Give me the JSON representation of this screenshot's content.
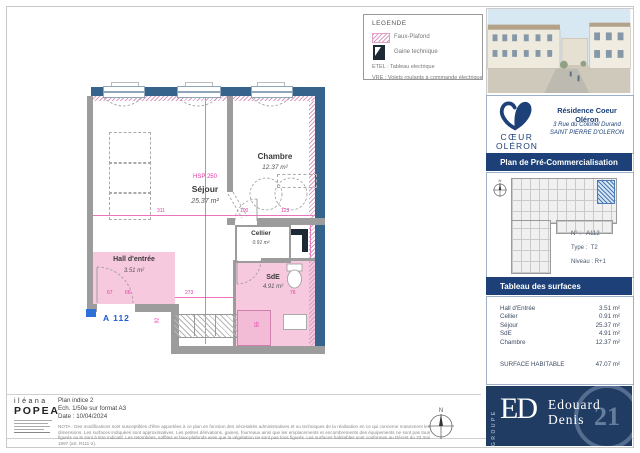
{
  "colors": {
    "navy": "#1c4077",
    "wall_blue": "#35638c",
    "faux_plafond_pink": "#f6c9de",
    "dimension_magenta": "#e437a3",
    "unit_label_blue": "#1d5dd0"
  },
  "legend": {
    "title": "LEGENDE",
    "faux_plafond": "Faux-Plafond",
    "gaine": "Gaine technique",
    "etel": "ETEL : Tableau electrique",
    "vre": "VRE : Volets roulants à commande électrique"
  },
  "plan": {
    "unit": "A 112",
    "hsp": "HSP 250",
    "compass_n": "N",
    "sejour": {
      "name": "Séjour",
      "area": "25.37 m²"
    },
    "chambre": {
      "name": "Chambre",
      "area": "12.37 m²"
    },
    "cellier": {
      "name": "Cellier",
      "area": "0.91 m²"
    },
    "sde": {
      "name": "SdE",
      "area": "4.91 m²"
    },
    "hall": {
      "name": "Hall d'entrée",
      "area": "3.51 m²"
    },
    "dims": [
      "311",
      "100",
      "123",
      "67",
      "66",
      "273",
      "76",
      "92",
      "55"
    ]
  },
  "sidebar": {
    "residence": "Résidence Coeur Oléron",
    "address1": "3 Rue du Colonel Durand",
    "address2": "SAINT PIERRE D'OLERON",
    "logo_line1": "CŒUR",
    "logo_line2": "OLÉRON",
    "banner_plan": "Plan de Pré-Commercialisation",
    "info": [
      {
        "label": "N° :",
        "value": "A112"
      },
      {
        "label": "Type :",
        "value": "T2"
      },
      {
        "label": "Niveau :",
        "value": "R+1"
      }
    ],
    "banner_surfaces": "Tableau des surfaces",
    "surfaces": [
      {
        "name": "Hall d'Entrée",
        "value": "3.51 m²"
      },
      {
        "name": "Cellier",
        "value": "0.91 m²"
      },
      {
        "name": "Séjour",
        "value": "25.37 m²"
      },
      {
        "name": "SdE",
        "value": "4.91 m²"
      },
      {
        "name": "Chambre",
        "value": "12.37 m²"
      }
    ],
    "total_label": "SURFACE HABITABLE",
    "total_value": "47.07 m²",
    "brand": {
      "groupe": "GROUPE",
      "monogram": "ED",
      "name_line1": "Edouard",
      "name_line2": "Denis",
      "badge": "21"
    }
  },
  "titleblock": {
    "architect_first": "iléana",
    "architect_last": "POPEA",
    "plan_line1": "Plan indice 2",
    "plan_line2": "Ech. 1/50e sur format A3",
    "plan_line3": "Date : 10/04/2024",
    "nota": "NOTA : Des modifications sont susceptibles d'être apportées à ce plan en fonction des nécessités administratives et ou techniques de la réalisation en ce qui concerne notamment les dimensions. Les surfaces indiquées sont approximatives. Les petites dérivations, gaines, fourreaux ainsi que les emplacements et encombrements des équipements ne sont pas tous figurés ou le sont à titre indicatif. Les retombées, soffites et faux-plafonds ainsi que la végétation ne sont pas tous figurés. Les surfaces habitables sont conformes au Décret du 23 mai 1997 (art. R111-2)."
  }
}
